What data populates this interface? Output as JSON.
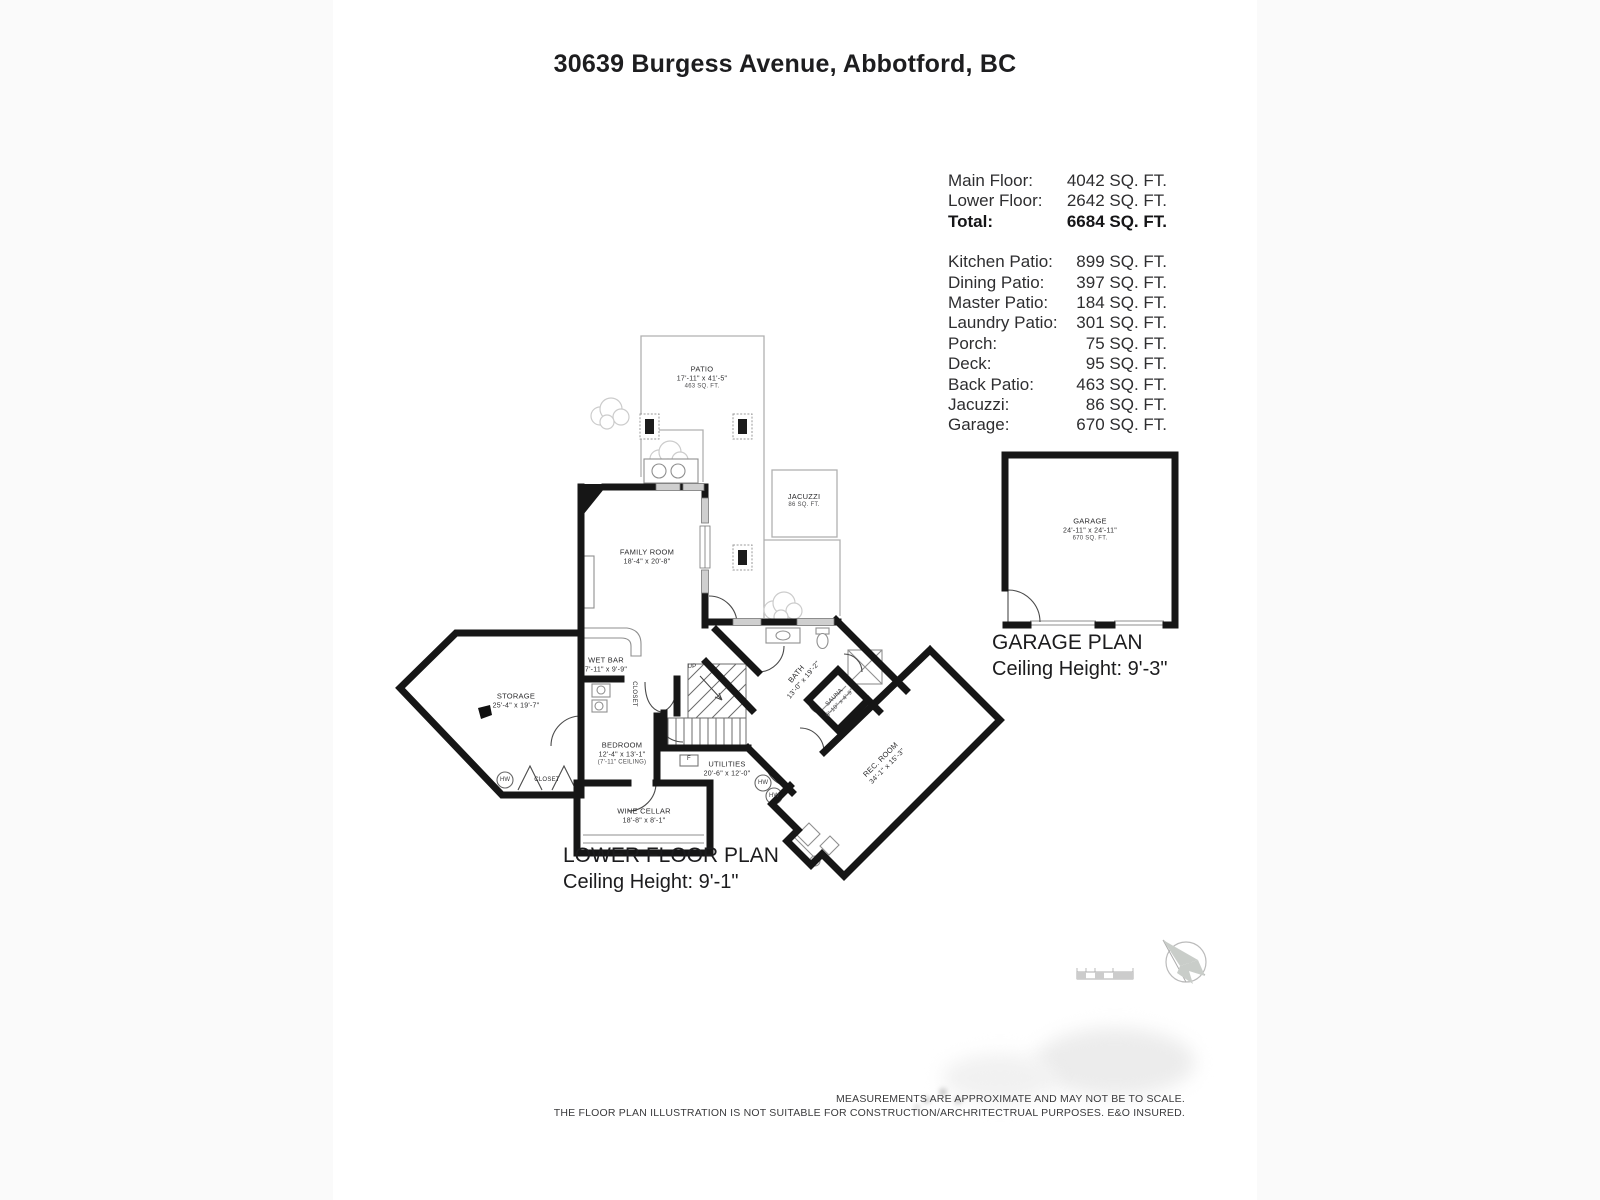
{
  "page": {
    "title": "30639 Burgess Avenue, Abbotford, BC"
  },
  "area_table": {
    "summary": [
      {
        "label": "Main Floor:",
        "value": "4042 SQ. FT."
      },
      {
        "label": "Lower Floor:",
        "value": "2642 SQ. FT."
      },
      {
        "label": "Total:",
        "value": "6684 SQ. FT."
      }
    ],
    "details": [
      {
        "label": "Kitchen Patio:",
        "value": "899 SQ. FT."
      },
      {
        "label": "Dining Patio:",
        "value": "397 SQ. FT."
      },
      {
        "label": "Master Patio:",
        "value": "184 SQ. FT."
      },
      {
        "label": "Laundry Patio:",
        "value": "301 SQ. FT."
      },
      {
        "label": "Porch:",
        "value": "75 SQ. FT."
      },
      {
        "label": "Deck:",
        "value": "95 SQ. FT."
      },
      {
        "label": "Back Patio:",
        "value": "463 SQ. FT."
      },
      {
        "label": "Jacuzzi:",
        "value": "86 SQ. FT."
      },
      {
        "label": "Garage:",
        "value": "670 SQ. FT."
      }
    ]
  },
  "lower_plan": {
    "heading": "LOWER FLOOR PLAN",
    "ceiling": "Ceiling Height: 9'-1\"",
    "rooms": {
      "patio": {
        "name": "PATIO",
        "dims": "17'-11\" x 41'-5\"",
        "area": "463 SQ. FT."
      },
      "jacuzzi": {
        "name": "JACUZZI",
        "area": "86 SQ. FT."
      },
      "family_room": {
        "name": "FAMILY ROOM",
        "dims": "18'-4\" x 20'-8\""
      },
      "storage": {
        "name": "STORAGE",
        "dims": "25'-4\" x 19'-7\""
      },
      "wet_bar": {
        "name": "WET BAR",
        "dims": "7'-11\" x 9'-9\""
      },
      "bedroom": {
        "name": "BEDROOM",
        "dims": "12'-4\" x 13'-1\"",
        "note": "(7'-11\" CEILING)"
      },
      "closet_side": {
        "name": "CLOSET"
      },
      "closet_bottom": {
        "name": "CLOSET"
      },
      "wine_cellar": {
        "name": "WINE CELLAR",
        "dims": "18'-8\" x 8'-1\""
      },
      "utilities": {
        "name": "UTILITIES",
        "dims": "20'-6\" x 12'-0\""
      },
      "bath": {
        "name": "BATH",
        "dims": "13'-0\" x 19'-2\""
      },
      "sauna": {
        "name": "SAUNA",
        "dims": "6'-10\" x 4'-9\""
      },
      "rec_room": {
        "name": "REC. ROOM",
        "dims": "34'-1\" x 15'-3\""
      },
      "up": "UP",
      "furnace": "F",
      "hw": "HW"
    }
  },
  "garage_plan": {
    "heading": "GARAGE PLAN",
    "ceiling": "Ceiling Height: 9'-3\"",
    "room": {
      "name": "GARAGE",
      "dims": "24'-11\" x 24'-11\"",
      "area": "670 SQ. FT."
    }
  },
  "disclaimer": {
    "line1": "MEASUREMENTS ARE APPROXIMATE AND MAY NOT BE TO SCALE.",
    "line2": "THE FLOOR PLAN ILLUSTRATION IS NOT SUITABLE FOR CONSTRUCTION/ARCHRITECTRUAL PURPOSES. E&O INSURED."
  },
  "colors": {
    "wall": "#161616",
    "thin": "#b0b0b0",
    "window": "#cfcfcf"
  }
}
